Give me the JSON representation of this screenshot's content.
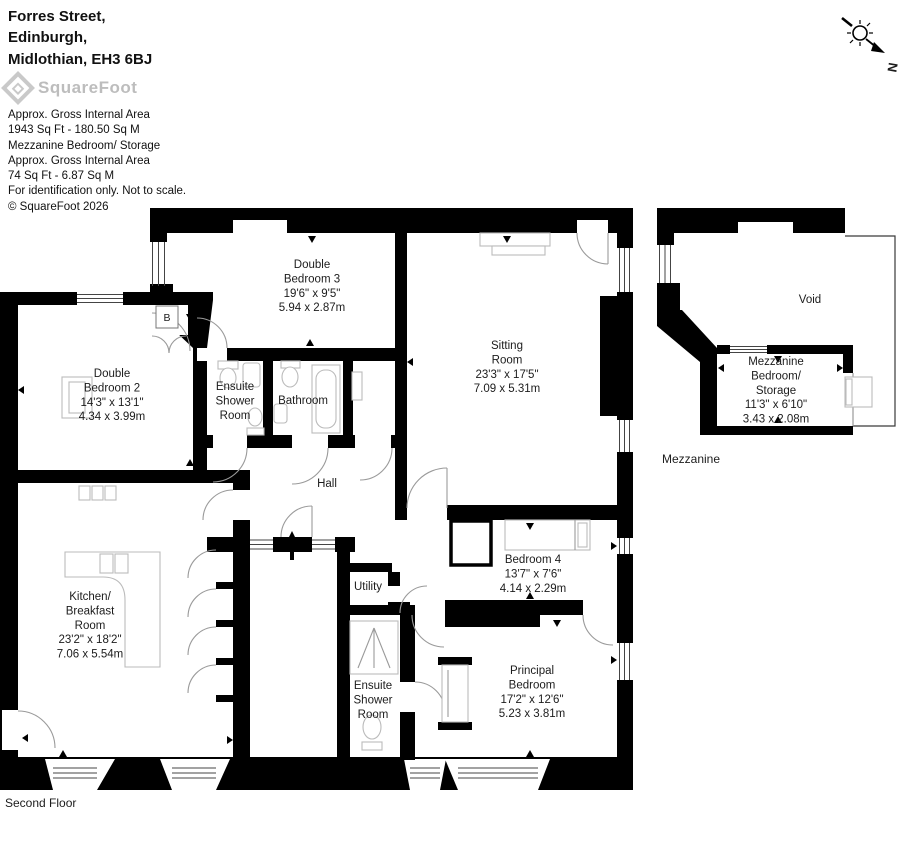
{
  "header": {
    "address": [
      "Forres Street,",
      "Edinburgh,",
      "Midlothian, EH3 6BJ"
    ],
    "logo": "SquareFoot",
    "notes": [
      "Approx. Gross Internal Area",
      "1943 Sq Ft  -  180.50 Sq M",
      "Mezzanine Bedroom/ Storage",
      "Approx. Gross Internal Area",
      "74 Sq Ft  -  6.87 Sq M",
      "For identification only. Not to scale.",
      "© SquareFoot 2026"
    ]
  },
  "compass": {
    "north": "N"
  },
  "floors": {
    "main": "Second Floor",
    "mezzanine": "Mezzanine"
  },
  "rooms": {
    "bedroom3": [
      "Double",
      "Bedroom 3",
      "19'6\" x 9'5\"",
      "5.94 x 2.87m"
    ],
    "sitting": [
      "Sitting",
      "Room",
      "23'3\" x 17'5\"",
      "7.09 x 5.31m"
    ],
    "bedroom2": [
      "Double",
      "Bedroom 2",
      "14'3\" x 13'1\"",
      "4.34 x 3.99m"
    ],
    "ensuite_shower_1": [
      "Ensuite",
      "Shower",
      "Room"
    ],
    "bathroom": "Bathroom",
    "hall": "Hall",
    "kitchen": [
      "Kitchen/",
      "Breakfast",
      "Room",
      "23'2\" x 18'2\"",
      "7.06 x 5.54m"
    ],
    "utility": "Utility",
    "ensuite_shower_2": [
      "Ensuite",
      "Shower",
      "Room"
    ],
    "bedroom4": [
      "Bedroom 4",
      "13'7\" x 7'6\"",
      "4.14 x 2.29m"
    ],
    "principal": [
      "Principal",
      "Bedroom",
      "17'2\" x 12'6\"",
      "5.23 x 3.81m"
    ],
    "mezzanine_bedroom": [
      "Mezzanine",
      "Bedroom/",
      "Storage",
      "11'3\" x 6'10\"",
      "3.43 x 2.08m"
    ],
    "void": "Void",
    "boiler": "B"
  }
}
